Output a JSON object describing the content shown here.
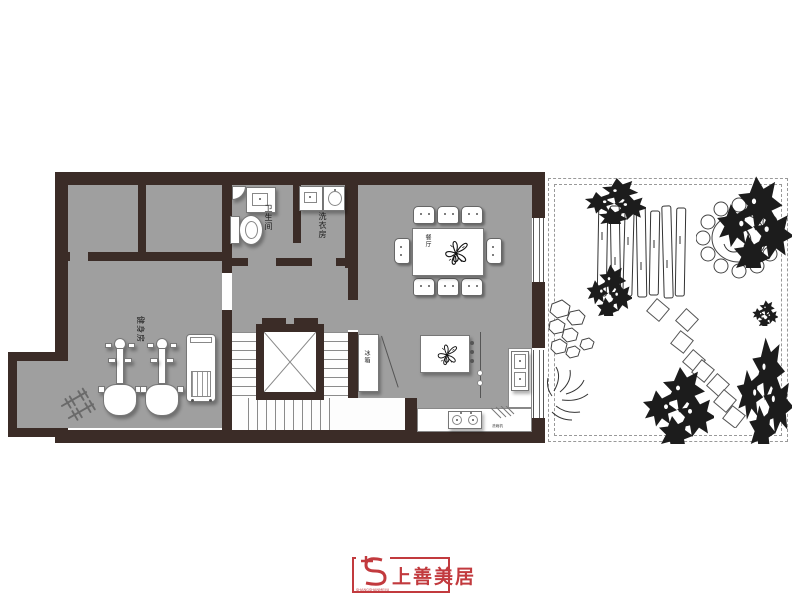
{
  "palette": {
    "wall": "#3b2c27",
    "floor": "#9f9f9f",
    "line": "#666666",
    "garden_line": "#333333",
    "logo_red": "#c23a3e"
  },
  "labels": {
    "bathroom": "卫生间",
    "laundry": "洗衣房",
    "gym": "健身房",
    "dining": "餐厅",
    "fridge": "冰箱",
    "dishwasher": "洗碗机"
  },
  "logo": {
    "brand": "上善美居",
    "subtext": "SHANGSHANMEIJU"
  }
}
